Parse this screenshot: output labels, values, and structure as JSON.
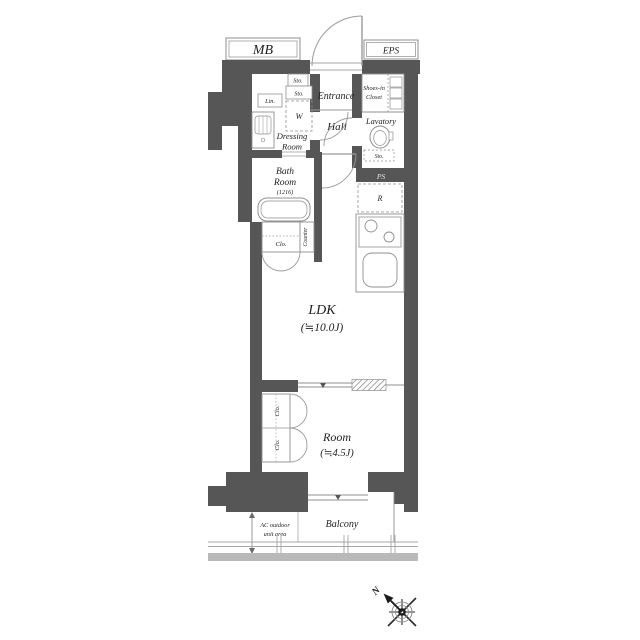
{
  "colors": {
    "wall": "#565656",
    "line": "#8f8f8f",
    "thin": "#a6a6a6",
    "text": "#1f1f1f",
    "rail_band": "#b9b9b9"
  },
  "top_boxes": {
    "mb": "MB",
    "eps": "EPS"
  },
  "rooms": {
    "entrance": "Entrance",
    "hall": "Hall",
    "shoes_closet_line1": "Shoes-in",
    "shoes_closet_line2": "Closet",
    "lavatory": "Lavatory",
    "dressing_line1": "Dressing",
    "dressing_line2": "Room",
    "bath_line1": "Bath",
    "bath_line2": "Room",
    "bath_size": "(1216)",
    "ldk": "LDK",
    "ldk_size": "(≒10.0J)",
    "room": "Room",
    "room_size": "(≒4.5J)",
    "balcony": "Balcony",
    "ac_line1": "AC outdoor",
    "ac_line2": "unit area"
  },
  "storage": {
    "entrance_sto": "Sto.",
    "dressing_sto": "Sto.",
    "washer": "W",
    "linen": "Lin.",
    "lavatory_sto": "Sto.",
    "bath_closet": "Clo.",
    "counter": "Counter",
    "room_closet_upper": "Clo.",
    "room_closet_lower": "Clo.",
    "fridge": "R",
    "pipe_space": "PS"
  },
  "compass": {
    "north": "N"
  }
}
